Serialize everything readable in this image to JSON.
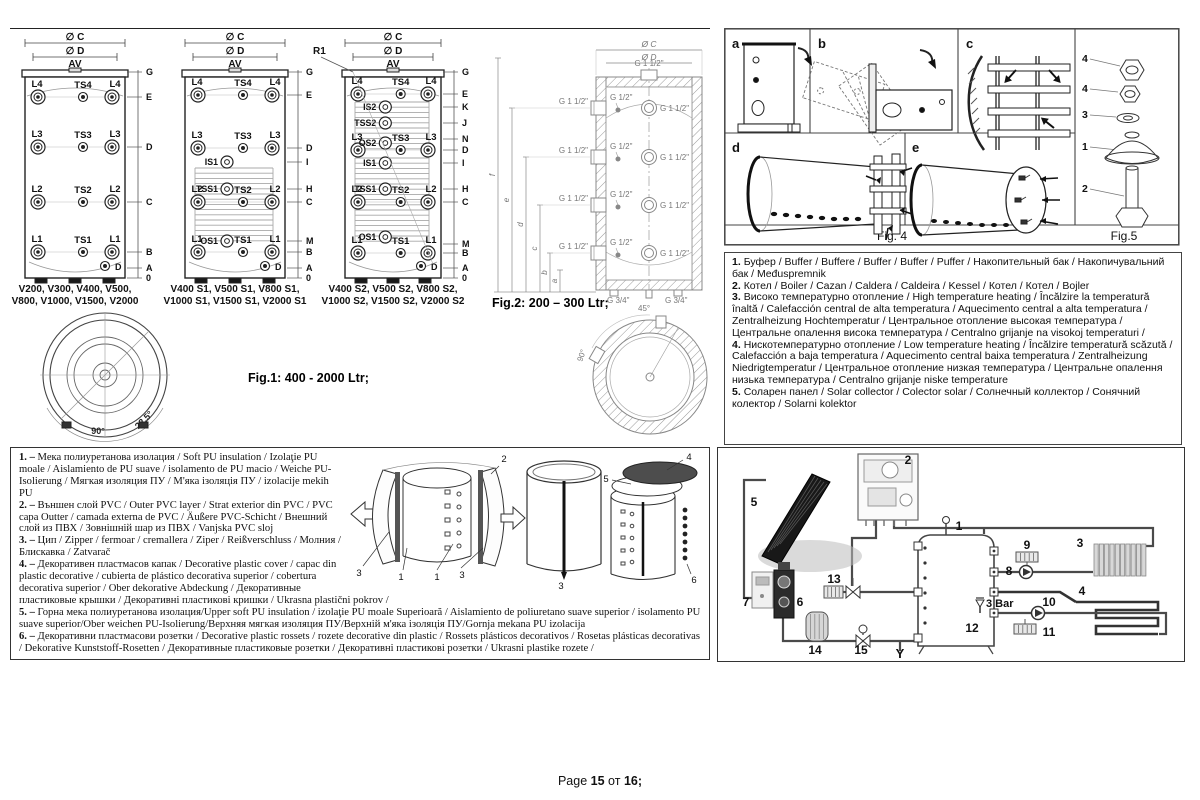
{
  "footer": {
    "prefix": "Page",
    "page": "15",
    "sep": "от",
    "total": "16;"
  },
  "fig1": {
    "caption": "Fig.1: 400 - 2000 Ltr;",
    "dims": [
      "∅ C",
      "∅ D",
      "AV"
    ],
    "angle_small": "22.5°",
    "angle_large": "90°",
    "r1": "R1",
    "tanks": [
      {
        "x": 15,
        "w": 100,
        "models": [
          "V200, V300, V400, V500,",
          "V800, V1000, V1500, V2000"
        ],
        "letters": [
          [
            "G",
            42
          ],
          [
            "E",
            67
          ],
          [
            "D",
            117
          ],
          [
            "C",
            172
          ],
          [
            "B",
            222
          ],
          [
            "A",
            238
          ],
          [
            "0",
            248
          ]
        ],
        "rows": [
          {
            "y": 67,
            "l": "L4",
            "m": "TS4",
            "r": "L4"
          },
          {
            "y": 117,
            "l": "L3",
            "m": "TS3",
            "r": "L3"
          },
          {
            "y": 172,
            "l": "L2",
            "m": "TS2",
            "r": "L2"
          },
          {
            "y": 222,
            "l": "L1",
            "m": "TS1",
            "r": "L1"
          }
        ],
        "mids": [],
        "coils": [],
        "bottom": "D"
      },
      {
        "x": 175,
        "w": 100,
        "models": [
          "V400 S1, V500 S1, V800 S1,",
          "V1000 S1, V1500 S1, V2000 S1"
        ],
        "letters": [
          [
            "G",
            42
          ],
          [
            "E",
            65
          ],
          [
            "D",
            118
          ],
          [
            "I",
            132
          ],
          [
            "H",
            159
          ],
          [
            "C",
            172
          ],
          [
            "M",
            211
          ],
          [
            "B",
            222
          ],
          [
            "A",
            238
          ],
          [
            "0",
            248
          ]
        ],
        "rows": [
          {
            "y": 65,
            "l": "L4",
            "m": "TS4",
            "r": "L4"
          },
          {
            "y": 118,
            "l": "L3",
            "m": "TS3",
            "r": "L3"
          },
          {
            "y": 172,
            "l": "L2",
            "m": "TS2",
            "r": "L2"
          },
          {
            "y": 222,
            "l": "L1",
            "m": "TS1",
            "r": "L1"
          }
        ],
        "mids": [
          {
            "y": 132,
            "t": "IS1"
          },
          {
            "y": 159,
            "t": "TSS1"
          },
          {
            "y": 211,
            "t": "OS1"
          }
        ],
        "coils": [
          [
            138,
            214
          ]
        ],
        "bottom": "D"
      },
      {
        "x": 335,
        "w": 96,
        "models": [
          "V400 S2, V500 S2, V800 S2,",
          "V1000 S2, V1500 S2, V2000 S2"
        ],
        "letters": [
          [
            "G",
            42
          ],
          [
            "E",
            64
          ],
          [
            "K",
            77
          ],
          [
            "J",
            93
          ],
          [
            "N",
            109
          ],
          [
            "D",
            120
          ],
          [
            "I",
            133
          ],
          [
            "H",
            159
          ],
          [
            "C",
            172
          ],
          [
            "M",
            214
          ],
          [
            "B",
            223
          ],
          [
            "A",
            238
          ],
          [
            "0",
            248
          ]
        ],
        "rows": [
          {
            "y": 64,
            "l": "L4",
            "m": "TS4",
            "r": "L4"
          },
          {
            "y": 120,
            "l": "L3",
            "m": "TS3",
            "r": "L3"
          },
          {
            "y": 172,
            "l": "L2",
            "m": "TS2",
            "r": "L2"
          },
          {
            "y": 223,
            "l": "L1",
            "m": "TS1",
            "r": "L1"
          }
        ],
        "mids": [
          {
            "y": 77,
            "t": "IS2"
          },
          {
            "y": 93,
            "t": "TSS2"
          },
          {
            "y": 113,
            "t": "OS2"
          },
          {
            "y": 133,
            "t": "IS1"
          },
          {
            "y": 159,
            "t": "TSS1"
          },
          {
            "y": 207,
            "t": "OS1"
          }
        ],
        "coils": [
          [
            72,
            122
          ],
          [
            128,
            212
          ]
        ],
        "bottom": "D",
        "r1": true
      }
    ]
  },
  "fig2": {
    "caption": "Fig.2: 200 – 300 Ltr;",
    "dim_c": "Ø C",
    "dim_d": "Ø D",
    "port_large": "G 1 1/2\"",
    "port_small": "G 1/2\"",
    "port_bottom": "G 3/4\"",
    "letters": [
      "f",
      "e",
      "d",
      "c",
      "b",
      "a"
    ],
    "angle_45": "45°",
    "angle_90": "90°"
  },
  "fig4": {
    "cells": [
      "a",
      "b",
      "c",
      "d",
      "e"
    ],
    "caption": "Fig. 4"
  },
  "fig5": {
    "caption": "Fig.5",
    "parts": [
      "4",
      "4",
      "3",
      "1",
      "2"
    ]
  },
  "legend_right": {
    "items": [
      {
        "num": "1.",
        "text": "Буфер / Buffer / Buffere / Buffer / Buffer / Puffer / Накопительный бак / Накопичувальний бак / Međuspremnik"
      },
      {
        "num": "2.",
        "text": "Котел / Boiler / Cazan / Caldera / Caldeira / Kessel / Котел / Котел / Bojler"
      },
      {
        "num": "3.",
        "text": "Високо температурно отопление / High temperature heating / Încălzire la temperatură înaltă / Calefacción central de alta temperatura / Aquecimento central a alta temperatura / Zentralheizung Hochtemperatur / Центральное отопление высокая температура / Центральне опалення висока температура / Centralno grijanje na visokoj temperaturi /"
      },
      {
        "num": "4.",
        "text": "Нискотемпературно отопление / Low temperature heating / Încălzire temperatură scăzută / Calefacción a baja temperatura / Aquecimento central baixa temperatura / Zentralheizung Niedrigtemperatur / Центральное отопление низкая температура / Центральне опалення низька температура / Centralno grijanje niske temperature"
      },
      {
        "num": "5.",
        "text": "Соларен панел / Solar collector / Colector solar / Солнечный коллектор / Сонячний колектор / Solarni kolektor"
      }
    ]
  },
  "legend_left": {
    "items": [
      {
        "num": "1. –",
        "text": "Мека полиуретанова изолация / Soft PU insulation / Izolaţie PU moale / Aislamiento de PU suave / isolamento de PU macio / Weiche PU-Isolierung / Мягкая изоляция ПУ / М'яка ізоляція ПУ / izolacije mekih PU"
      },
      {
        "num": "2. –",
        "text": "Външен слой PVC / Outer PVC layer / Strat exterior din PVC / PVC capa Outter / camada externa de PVC / Äußere PVC-Schicht / Внешний слой из ПВХ / Зовнішній шар из ПВХ / Vanjska PVC sloj"
      },
      {
        "num": "3. –",
        "text": "Цип / Zipper / fermoar / cremallera / Ziper / Reißverschluss / Молния / Блискавка / Zatvarač"
      },
      {
        "num": "4. –",
        "text": "Декоративен пластмасов капак / Decorative plastic cover / capac din plastic decorative / cubierta de plástico decorativa superior / cobertura decorativa superior / Ober dekorative Abdeckung / Декоративные пластиковые крышки / Декоративні пластикові кришки / Ukrasna plastični pokrov /"
      },
      {
        "num": "5. –",
        "text": "Горна мека полиуретанова изолация/Upper soft PU insulation / izolaţie PU moale Superioară / Aislamiento de poliuretano suave superior / isolamento PU suave superior/Ober weichen PU-Isolierung/Верхняя мягкая изоляция ПУ/Верхній м'яка ізоляція ПУ/Gornja mekana PU izolacija"
      },
      {
        "num": "6. –",
        "text": "Декоративни пластмасови розетки / Decorative plastic rossets / rozete decorative din plastic / Rossets plásticos decorativos / Rosetas plásticas decorativas / Dekorative Kunststoff-Rosetten / Декоративные пластиковые розетки / Декоративні пластикові розетки / Ukrasni plastike rozete /"
      }
    ]
  },
  "assembly": {
    "labels": [
      "1",
      "2",
      "3",
      "4",
      "5",
      "6"
    ]
  },
  "schematic": {
    "labels": [
      "1",
      "2",
      "3",
      "4",
      "5",
      "6",
      "7",
      "8",
      "9",
      "10",
      "11",
      "12",
      "13",
      "14",
      "15"
    ],
    "pressure": "3 Bar",
    "drain": "Y"
  }
}
